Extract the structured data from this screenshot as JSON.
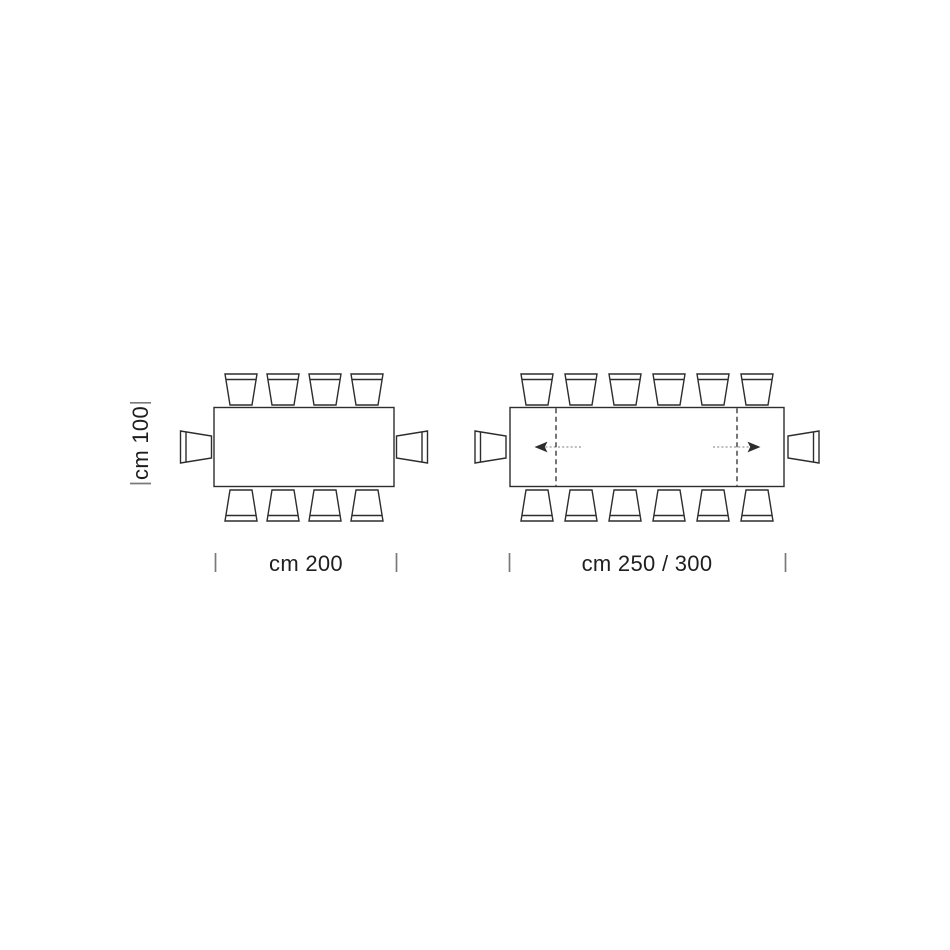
{
  "page": {
    "background_color": "#ffffff"
  },
  "diagram": {
    "line_color": "#2d2d2d",
    "text_color": "#1e1e1e",
    "tick_color": "#7a7a7a",
    "tables": [
      {
        "name": "fixed rectangular table, plan view",
        "width_label": "cm 200",
        "depth_label": "cm 100",
        "seats_long_side": 4,
        "seats_short_side": 1,
        "seats_total": 10,
        "extendable": false
      },
      {
        "name": "extendable rectangular table, plan view",
        "width_label": "cm 250 / 300",
        "seats_long_side": 6,
        "seats_short_side": 1,
        "seats_total": 14,
        "extendable": true,
        "extension_arrows": [
          "left",
          "right"
        ]
      }
    ]
  }
}
